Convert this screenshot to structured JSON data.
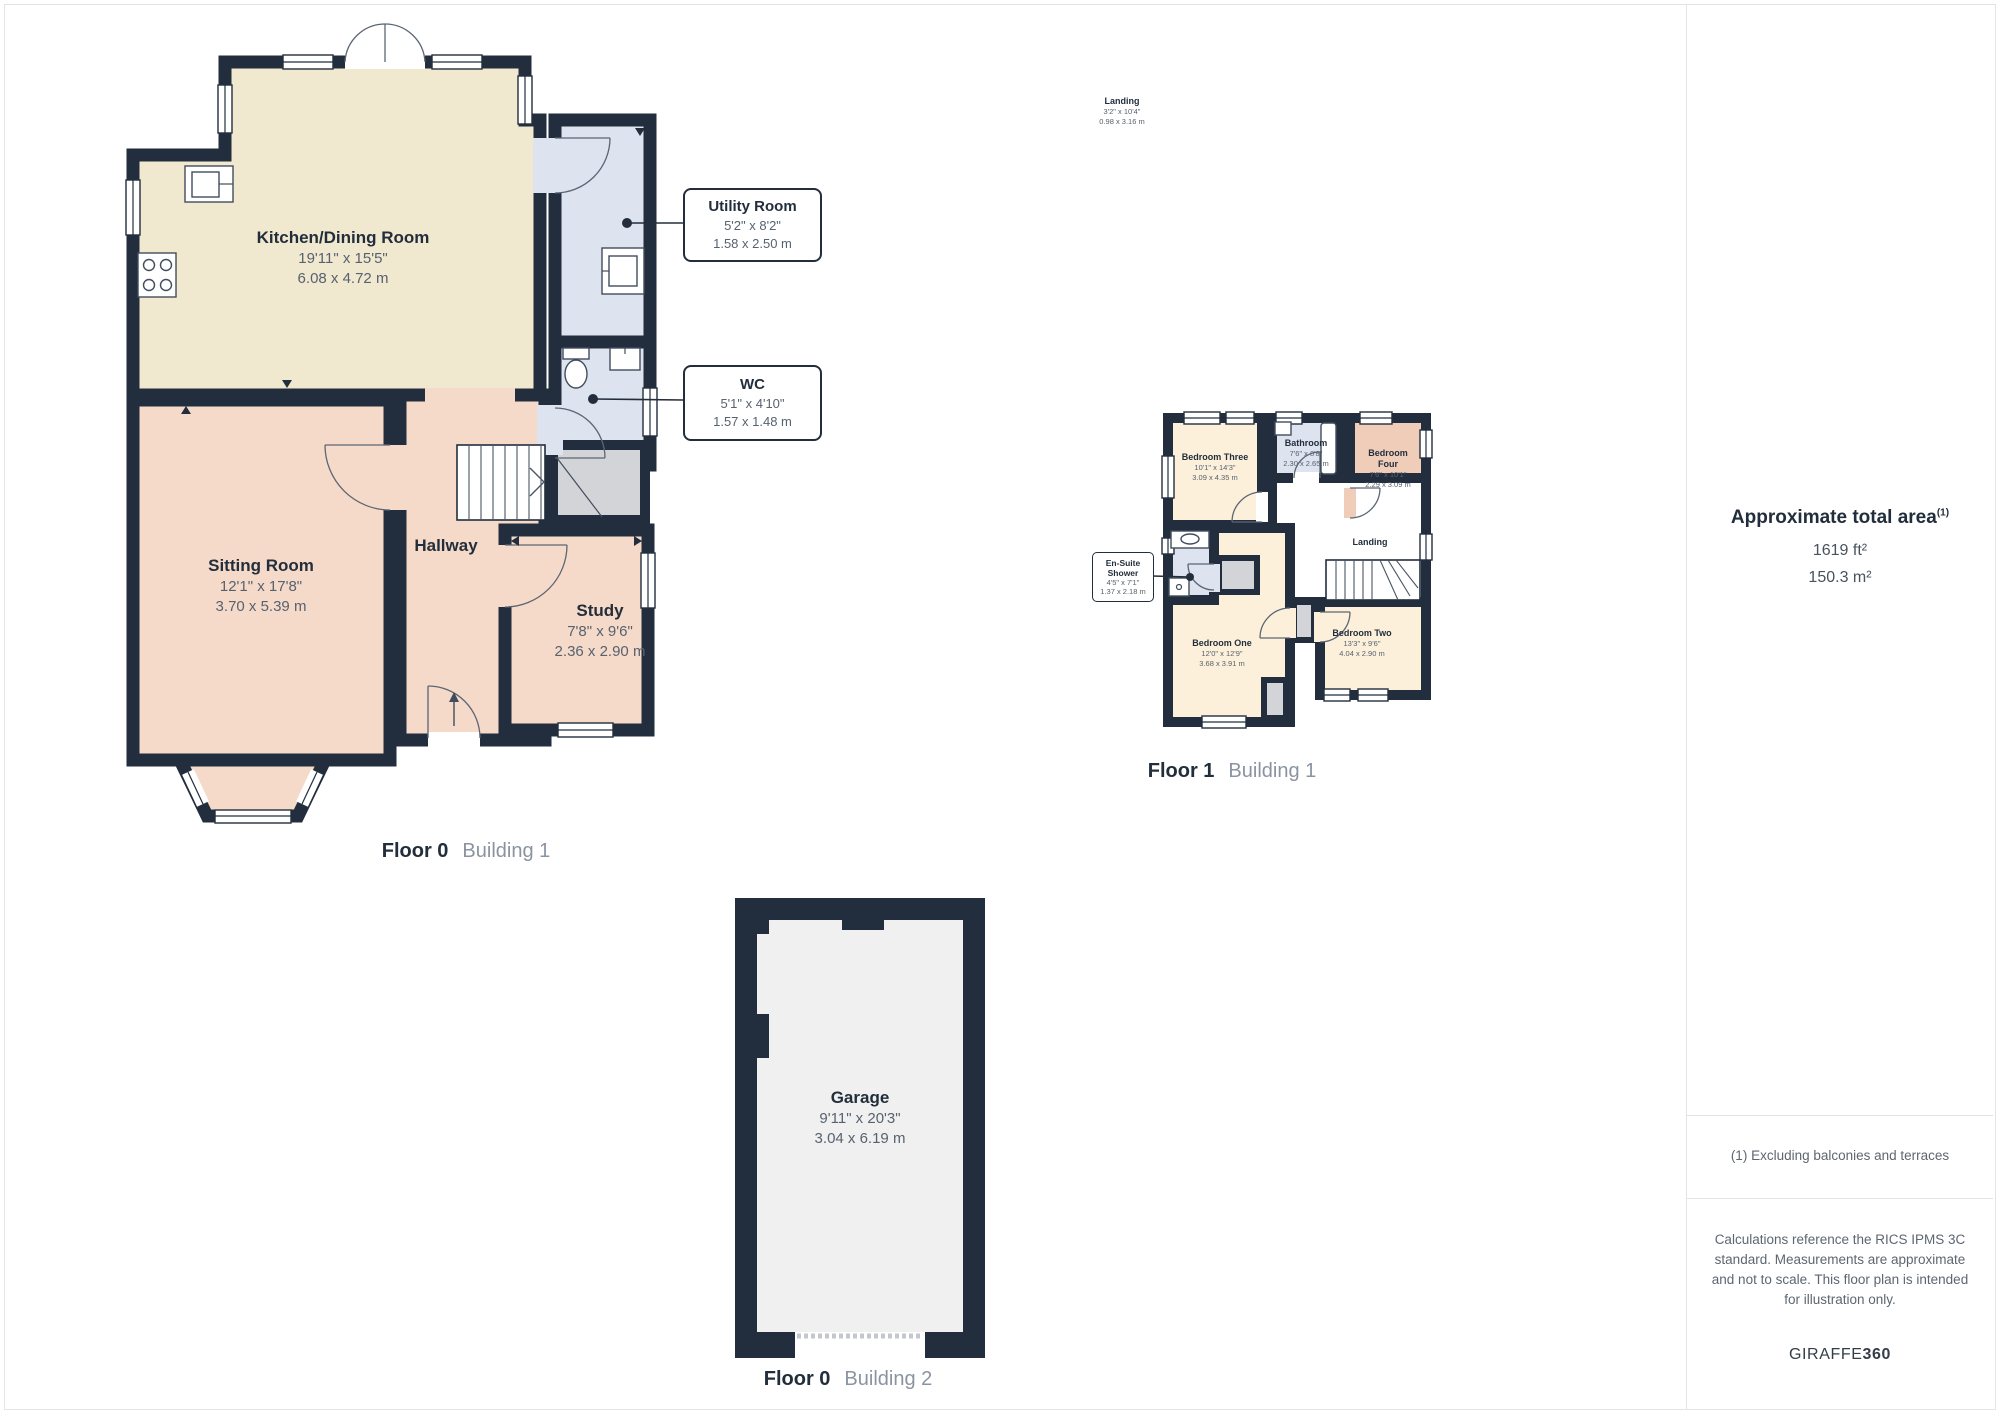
{
  "colors": {
    "wall": "#222e3d",
    "kitchen": "#f1e8d0",
    "lounge": "#f6dac9",
    "wet": "#dde3ef",
    "bedroom": "#fcf0da",
    "bedroom_accent": "#f0cdb9",
    "storage": "#d2d4d7",
    "garage": "#f0f0f1",
    "divider": "#e3e4e7"
  },
  "floor0": {
    "kitchen": {
      "name": "Kitchen/Dining Room",
      "imperial": "19'11\" x 15'5\"",
      "metric": "6.08 x 4.72 m"
    },
    "sitting": {
      "name": "Sitting Room",
      "imperial": "12'1\" x 17'8\"",
      "metric": "3.70 x 5.39 m"
    },
    "hallway": {
      "name": "Hallway"
    },
    "study": {
      "name": "Study",
      "imperial": "7'8\" x 9'6\"",
      "metric": "2.36 x 2.90 m"
    },
    "utility": {
      "name": "Utility Room",
      "imperial": "5'2\" x 8'2\"",
      "metric": "1.58 x 2.50 m"
    },
    "wc": {
      "name": "WC",
      "imperial": "5'1\" x 4'10\"",
      "metric": "1.57 x 1.48 m"
    }
  },
  "floor1": {
    "bedroom_three": {
      "name": "Bedroom Three",
      "imperial": "10'1\" x 14'3\"",
      "metric": "3.09 x 4.35 m"
    },
    "bathroom": {
      "name": "Bathroom",
      "imperial": "7'6\" x 8'8\"",
      "metric": "2.30 x 2.65 m"
    },
    "bedroom_four": {
      "name": "Bedroom Four",
      "imperial": "7'6\" x 10'1\"",
      "metric": "2.29 x 3.09 m"
    },
    "landing": {
      "name": "Landing"
    },
    "ensuite": {
      "name": "En-Suite Shower",
      "imperial": "4'5\" x 7'1\"",
      "metric": "1.37 x 2.18 m"
    },
    "bedroom_one": {
      "name": "Bedroom One",
      "imperial": "12'0\" x 12'9\"",
      "metric": "3.68 x 3.91 m"
    },
    "bedroom_two": {
      "name": "Bedroom Two",
      "imperial": "13'3\" x 9'6\"",
      "metric": "4.04 x 2.90 m"
    }
  },
  "landing_float": {
    "name": "Landing",
    "imperial": "3'2\" x 10'4\"",
    "metric": "0.98 x 3.16 m"
  },
  "garage": {
    "name": "Garage",
    "imperial": "9'11\" x 20'3\"",
    "metric": "3.04 x 6.19 m"
  },
  "captions": {
    "f0b1": {
      "floor": "Floor 0",
      "building": "Building 1"
    },
    "f1b1": {
      "floor": "Floor 1",
      "building": "Building 1"
    },
    "f0b2": {
      "floor": "Floor 0",
      "building": "Building 2"
    }
  },
  "sidebar": {
    "area_title": "Approximate total area",
    "area_marker": "(1)",
    "area_ft": "1619 ft²",
    "area_m": "150.3 m²",
    "footnote": "(1) Excluding balconies and terraces",
    "disclaimer": "Calculations reference the RICS IPMS 3C standard. Measurements are approximate and not to scale. This floor plan is intended for illustration only.",
    "brand_name": "GIRAFFE",
    "brand_number": "360"
  }
}
